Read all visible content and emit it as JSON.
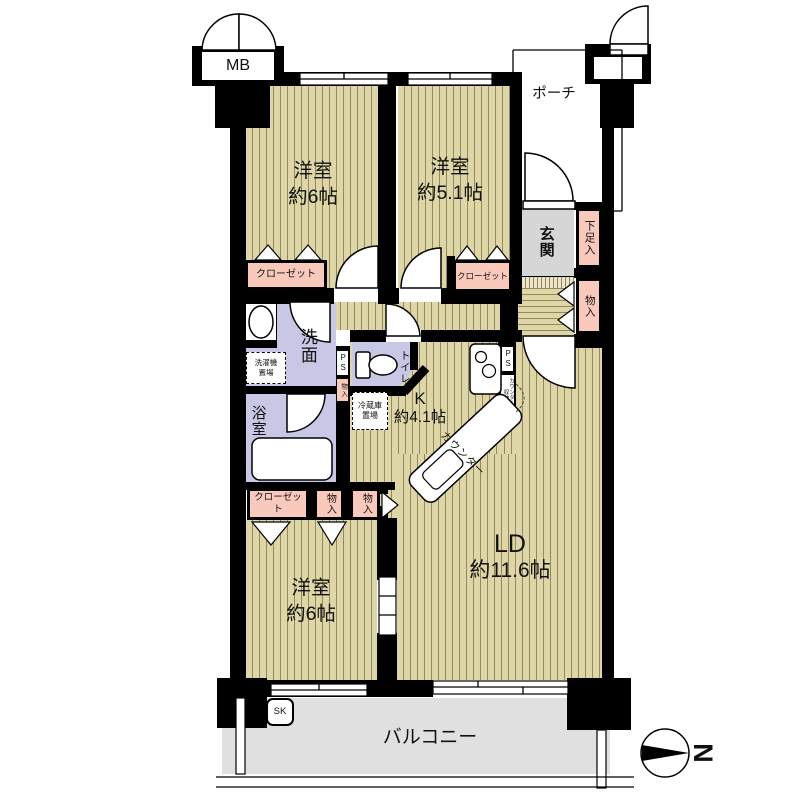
{
  "floorplan": {
    "labels": {
      "mb": "MB",
      "porch": "ポーチ",
      "genkan": "玄関",
      "shoe_box": "下足入",
      "closet": "クローゼット",
      "storage": "物入",
      "washroom": "洗面",
      "laundry_line1": "洗濯機",
      "laundry_line2": "置場",
      "bath": "浴室",
      "toilet": "トイレ",
      "fridge_line1": "冷蔵庫",
      "fridge_line2": "置場",
      "pipe_space": "PS",
      "counter": "カウンター",
      "counter_storage": "カウンター下収納",
      "balcony": "バルコニー",
      "slop_sink": "SK",
      "north": "N"
    },
    "rooms": {
      "bedroom1": {
        "name": "洋室",
        "size": "約6帖"
      },
      "bedroom2": {
        "name": "洋室",
        "size": "約5.1帖"
      },
      "bedroom3": {
        "name": "洋室",
        "size": "約6帖"
      },
      "living_dining": {
        "name": "LD",
        "size": "約11.6帖"
      },
      "kitchen": {
        "name": "K",
        "size": "約4.1帖"
      }
    },
    "colors": {
      "wall": "#000000",
      "floor_base": "#ded6a6",
      "floor_stripe": "#93895c",
      "closet_pink": "#f9cabb",
      "sanitary_lavender": "#c8c8e6",
      "entry_gray": "#d6d6d6",
      "balcony_gray": "#e0e0e0"
    }
  }
}
